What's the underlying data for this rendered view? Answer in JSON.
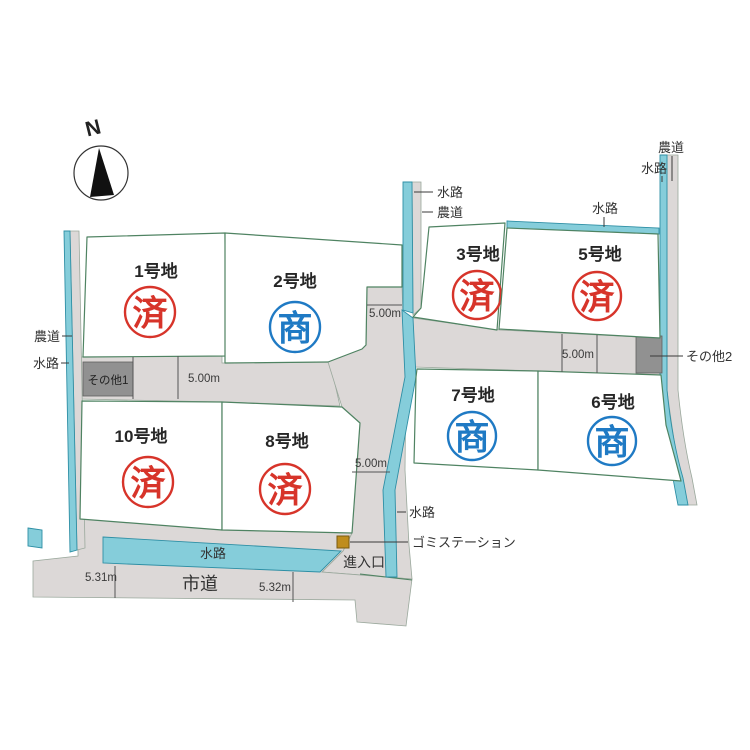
{
  "compass": {
    "north": "N"
  },
  "lots": [
    {
      "name": "1号地",
      "stamp": "済"
    },
    {
      "name": "2号地",
      "stamp": "商"
    },
    {
      "name": "3号地",
      "stamp": "済"
    },
    {
      "name": "5号地",
      "stamp": "済"
    },
    {
      "name": "7号地",
      "stamp": "商"
    },
    {
      "name": "6号地",
      "stamp": "商"
    },
    {
      "name": "10号地",
      "stamp": "済"
    },
    {
      "name": "8号地",
      "stamp": "済"
    }
  ],
  "labels": {
    "waterway": "水路",
    "farm_road": "農道",
    "city_road": "市道",
    "entrance": "進入口",
    "garbage_station": "ゴミステーション",
    "other1": "その他1",
    "other2": "その他2"
  },
  "measurements": {
    "road_width": "5.00m",
    "west_a": "5.31m",
    "west_b": "5.32m"
  },
  "colors": {
    "sold_stamp": "#d7342a",
    "negotiation_stamp": "#1f7ac4",
    "waterway": "#85cdda",
    "road": "#dcd8d7",
    "lot_border": "#4f8362",
    "other_block": "#919191",
    "garbage_marker": "#bf8d1e"
  }
}
